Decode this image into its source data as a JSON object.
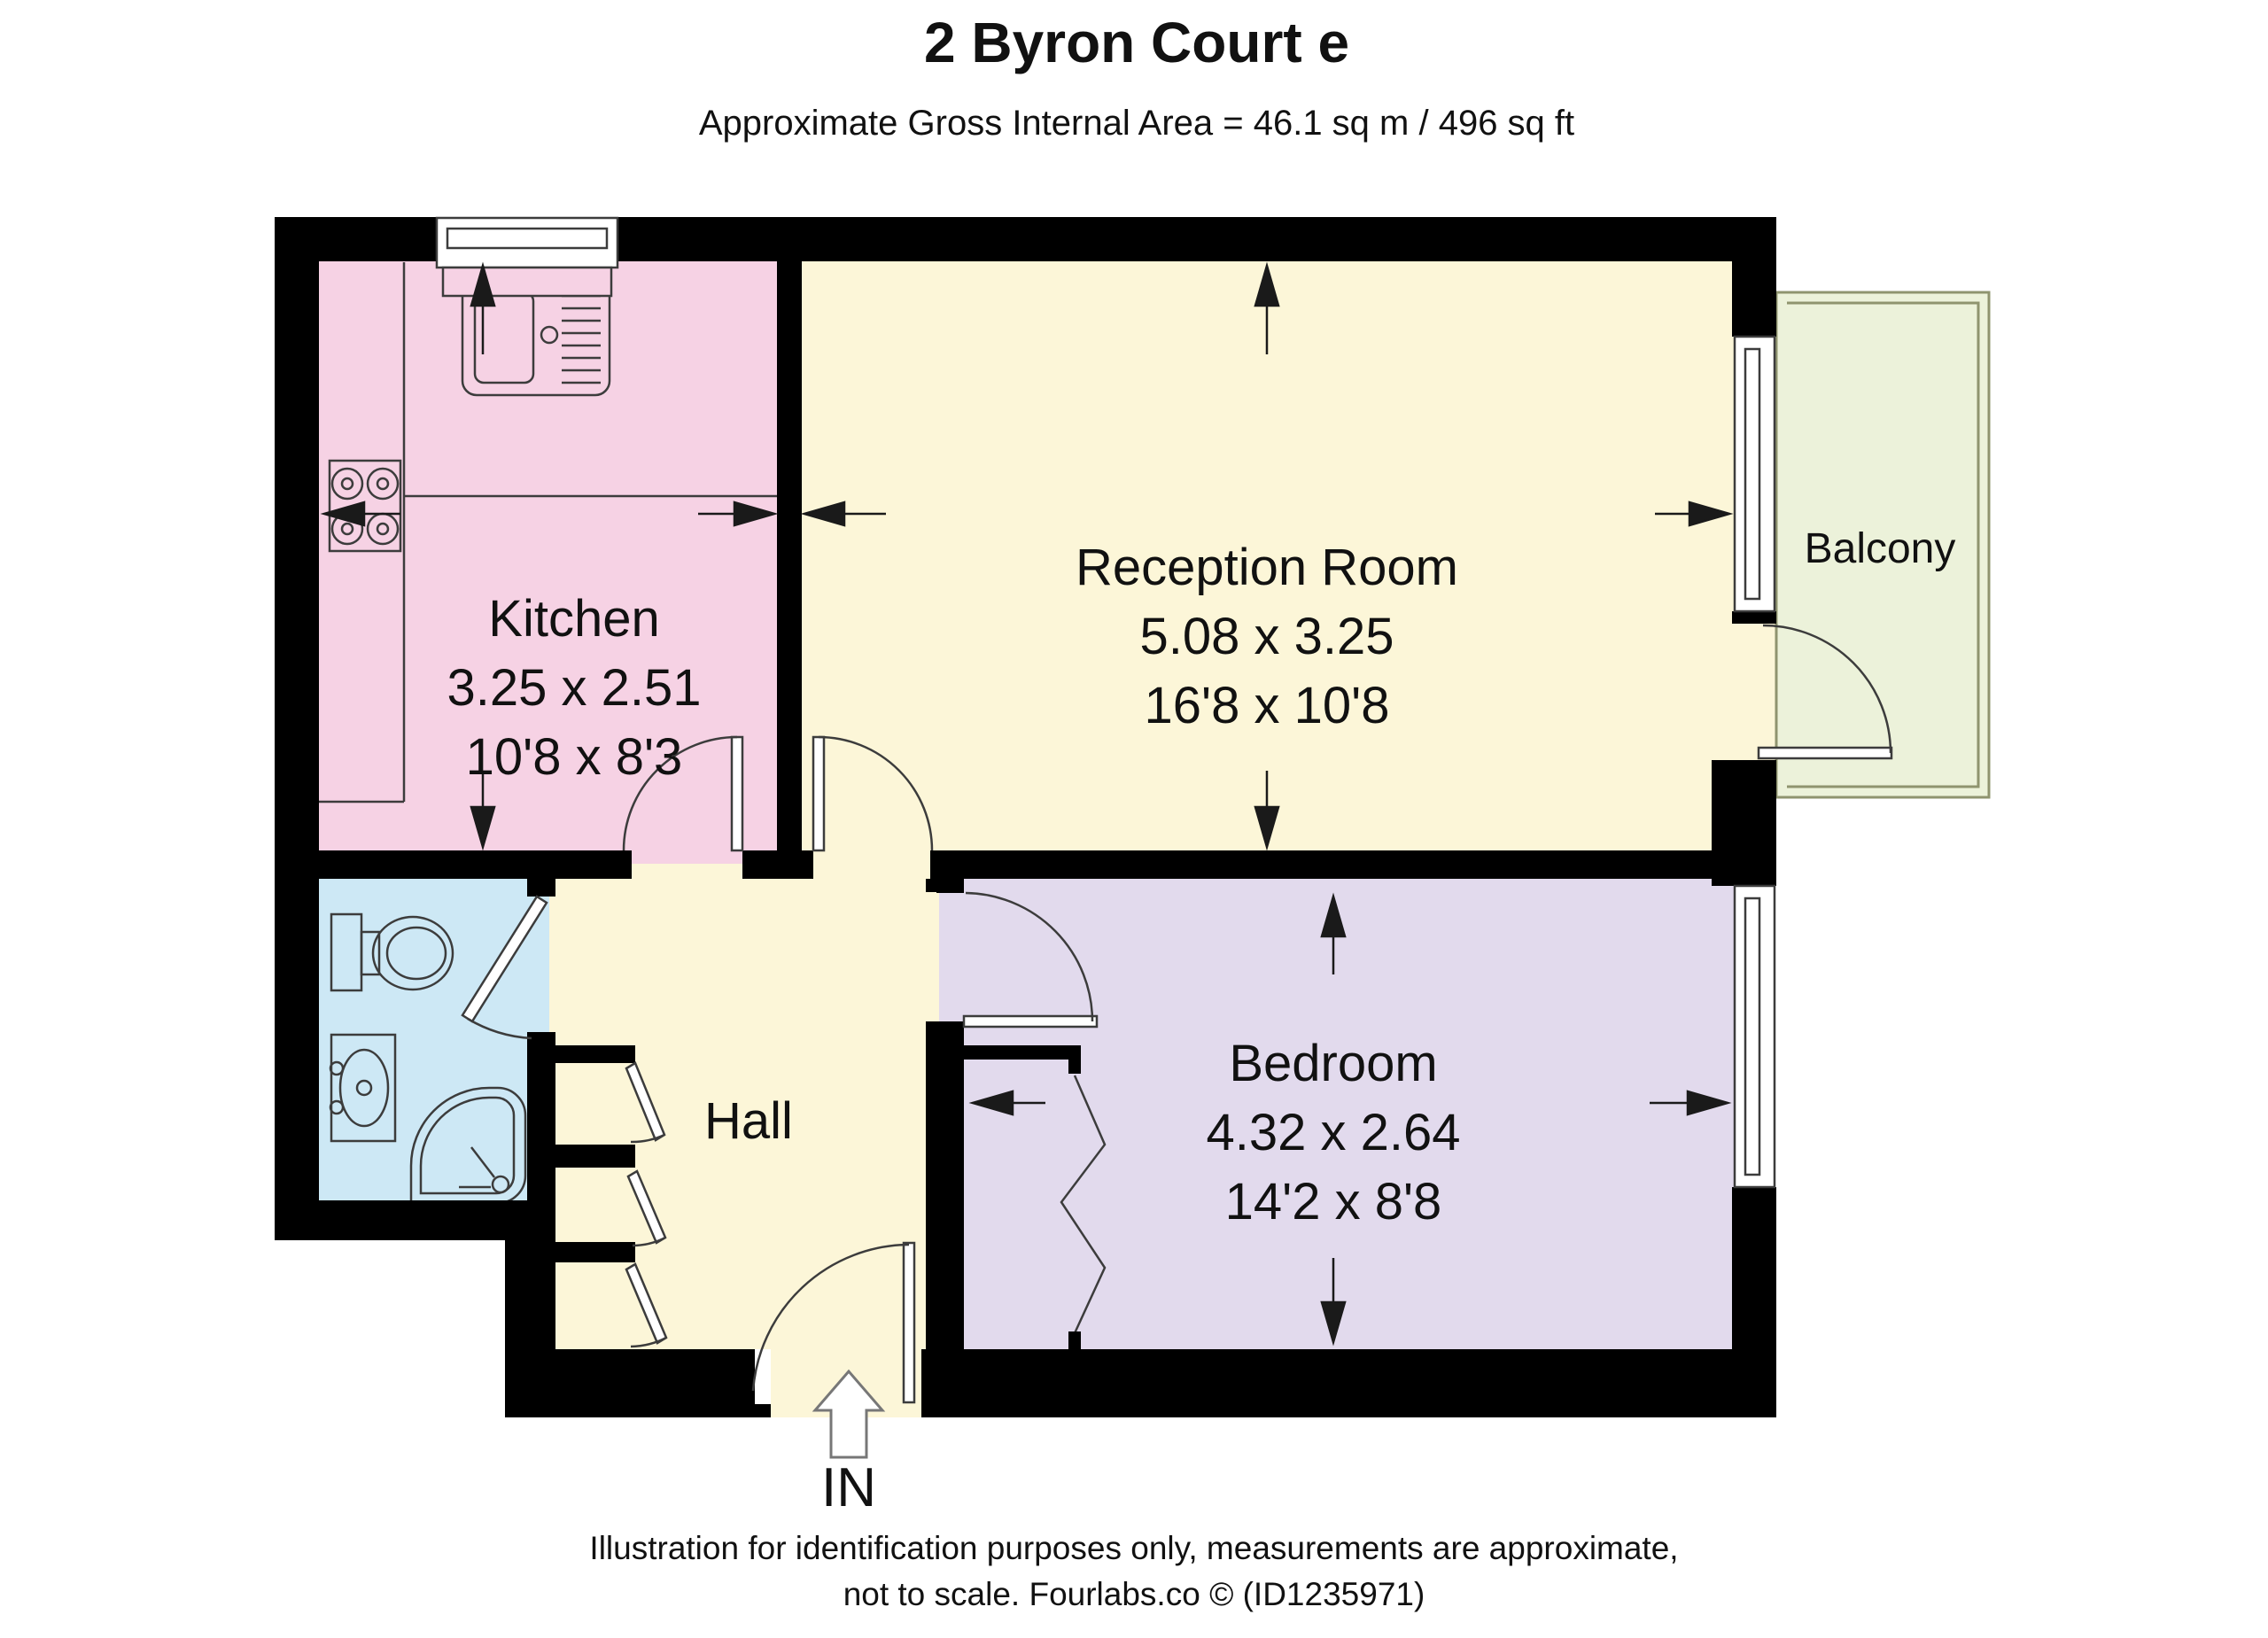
{
  "title": "2 Byron Court e",
  "subtitle": "Approximate Gross Internal Area = 46.1 sq m / 496 sq ft",
  "rooms": {
    "kitchen": {
      "name": "Kitchen",
      "dim_metric": "3.25 x 2.51",
      "dim_imperial": "10'8 x 8'3",
      "fill": "#f6d2e4"
    },
    "reception": {
      "name": "Reception Room",
      "dim_metric": "5.08 x 3.25",
      "dim_imperial": "16'8 x 10'8",
      "fill": "#fcf6d8"
    },
    "bedroom": {
      "name": "Bedroom",
      "dim_metric": "4.32 x 2.64",
      "dim_imperial": "14'2 x 8'8",
      "fill": "#e2daed"
    },
    "hall": {
      "name": "Hall",
      "fill": "#fcf6d8"
    },
    "bathroom": {
      "fill": "#cde8f5"
    },
    "balcony": {
      "name": "Balcony",
      "fill": "#ecf2da"
    }
  },
  "entrance": {
    "label": "IN"
  },
  "footer": {
    "line1": "Illustration for identification purposes only, measurements are approximate,",
    "line2": "not to scale. Fourlabs.co © (ID1235971)"
  },
  "colors": {
    "wall": "#000000",
    "line": "#3c3c3c",
    "balcony_border": "#8f946f"
  }
}
